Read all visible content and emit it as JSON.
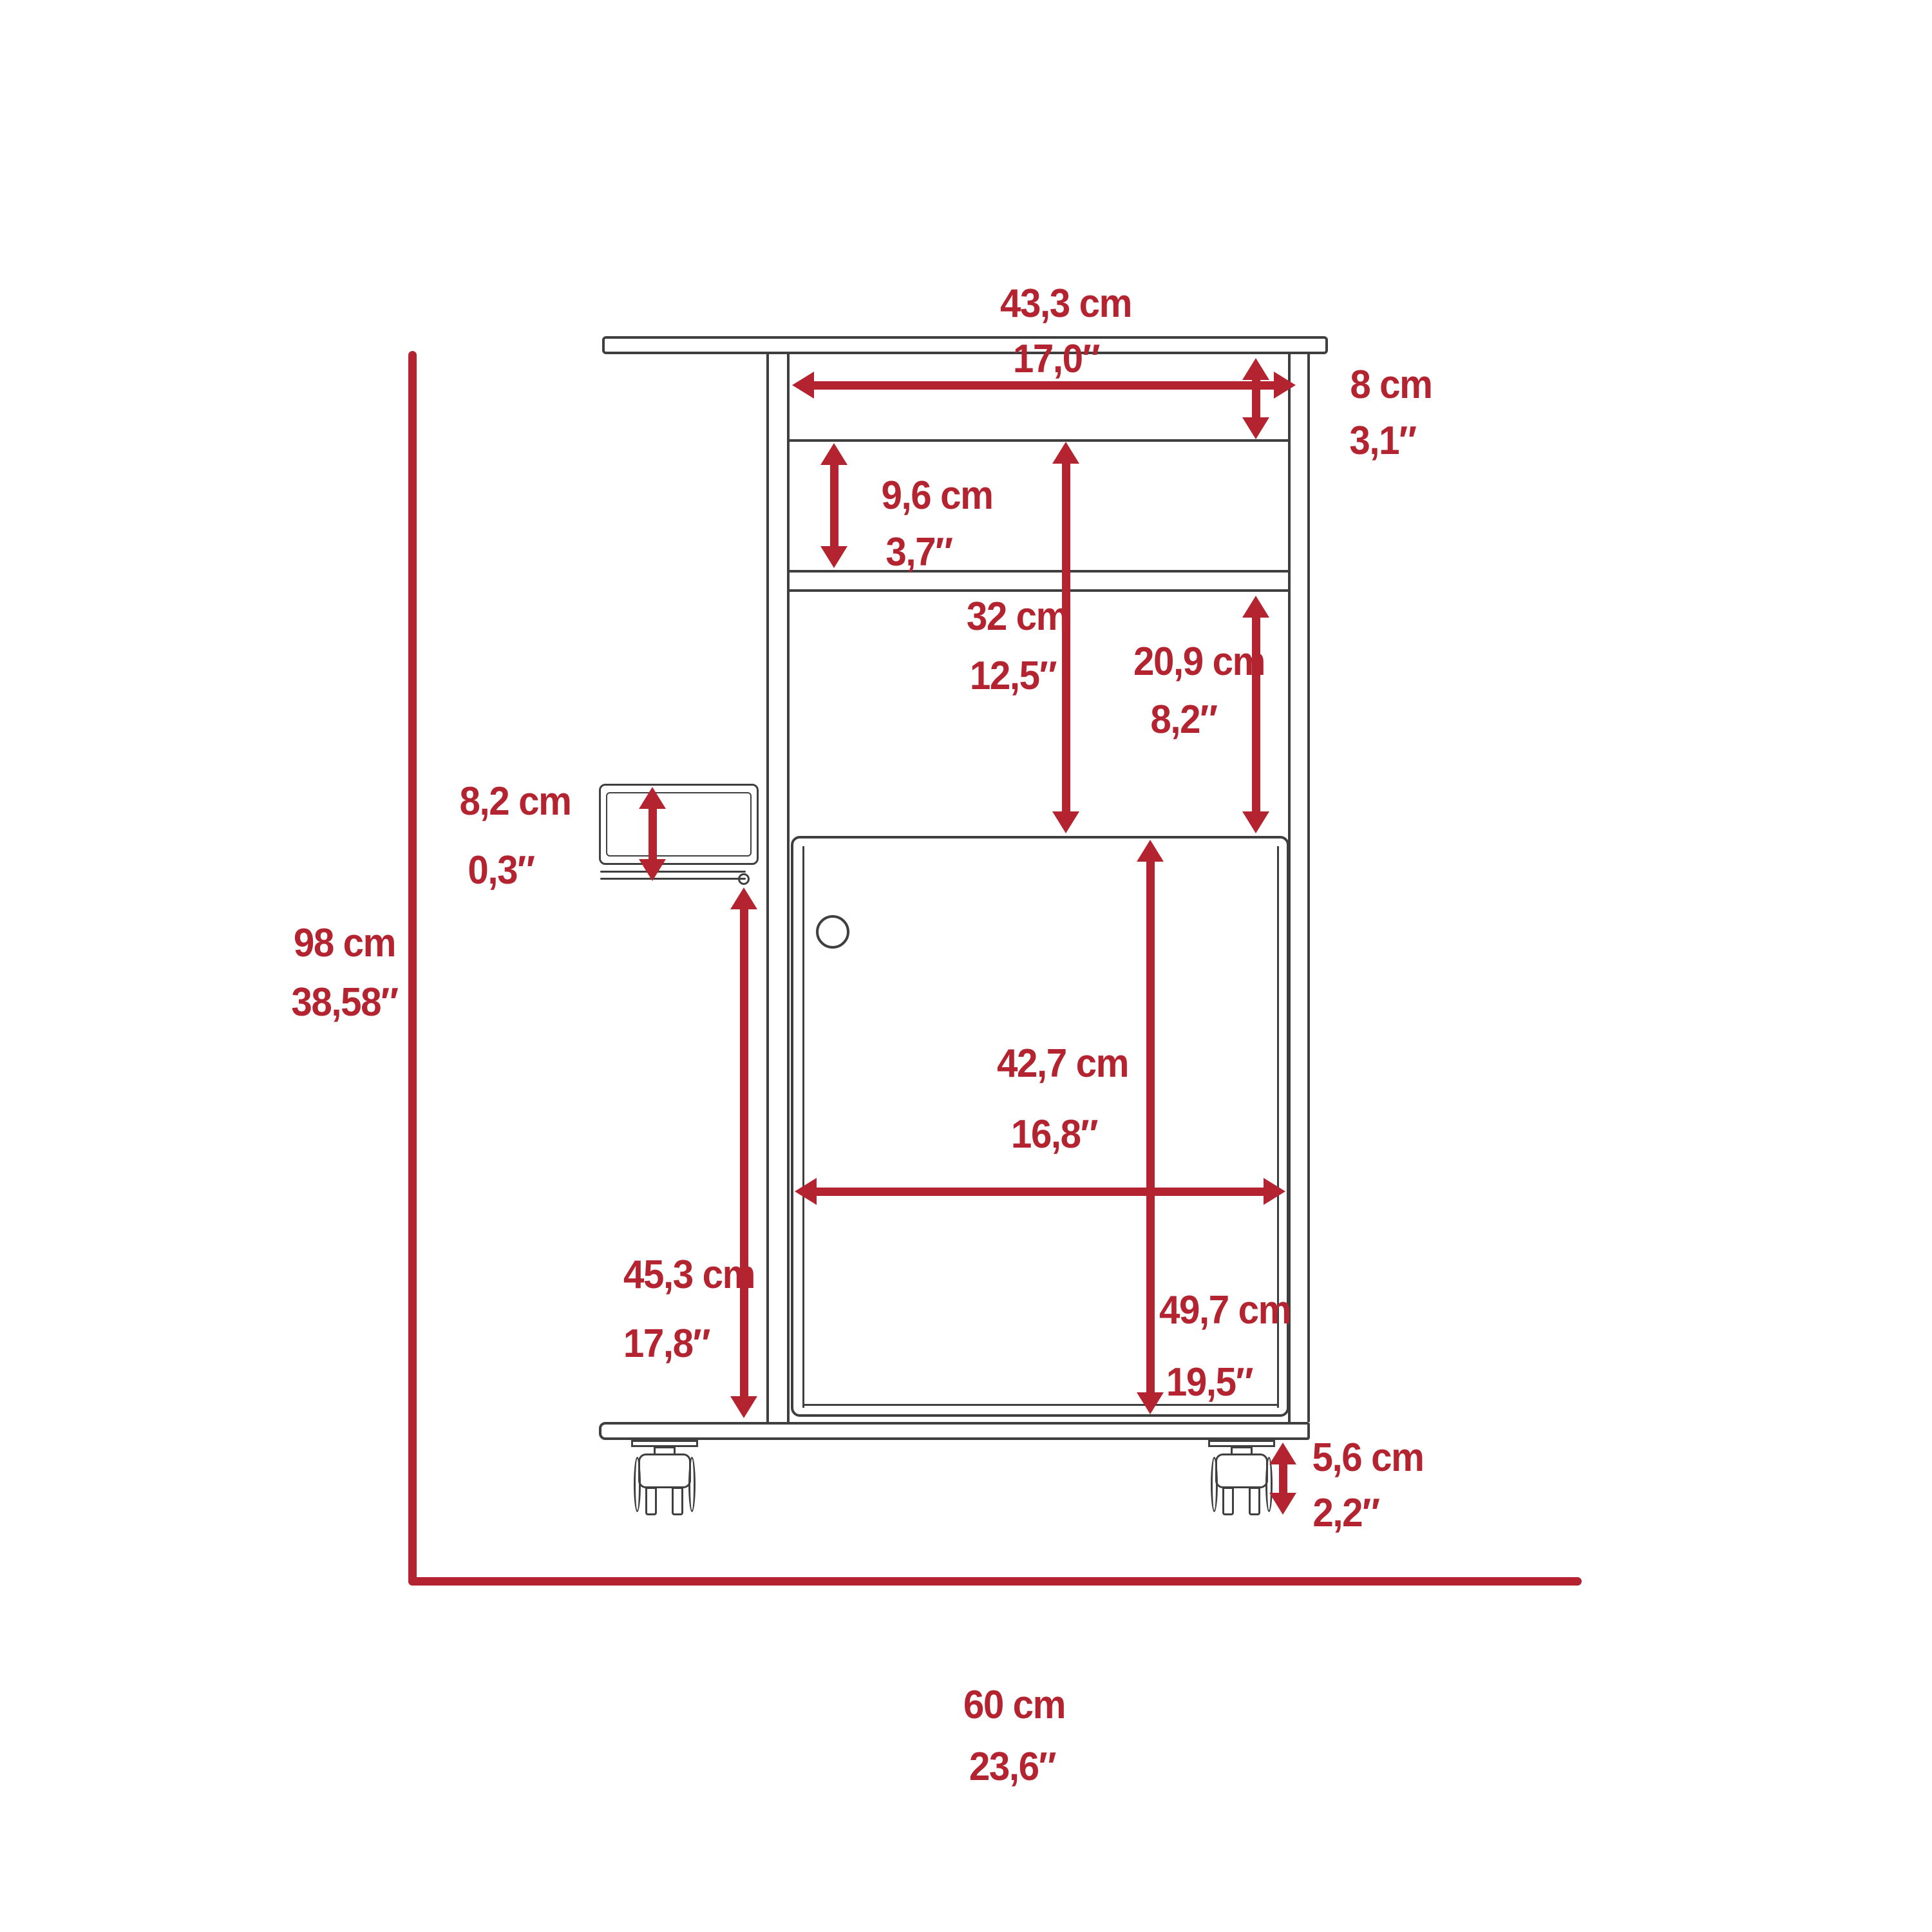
{
  "theme": {
    "accent_red": "#b42430",
    "line_ink": "#3f3f3f",
    "background": "#ffffff"
  },
  "diagram": {
    "kind": "furniture-dimension-drawing",
    "subject": "bar cart cabinet with casters, front elevation",
    "units": [
      "cm",
      "inches"
    ]
  },
  "dims": {
    "top_width": {
      "cm": "43,3 cm",
      "in": "17,0″"
    },
    "top_niche": {
      "cm": "8 cm",
      "in": "3,1″"
    },
    "mid_niche": {
      "cm": "9,6 cm",
      "in": "3,7″"
    },
    "open_height": {
      "cm": "32 cm",
      "in": "12,5″"
    },
    "shelf_clear": {
      "cm": "20,9 cm",
      "in": "8,2″"
    },
    "glass_rack": {
      "cm": "8,2 cm",
      "in": "0,3″"
    },
    "overall_height": {
      "cm": "98 cm",
      "in": "38,58″"
    },
    "door_width": {
      "cm": "42,7 cm",
      "in": "16,8″"
    },
    "left_lower": {
      "cm": "45,3 cm",
      "in": "17,8″"
    },
    "door_height": {
      "cm": "49,7 cm",
      "in": "19,5″"
    },
    "caster": {
      "cm": "5,6 cm",
      "in": "2,2″"
    },
    "overall_width": {
      "cm": "60 cm",
      "in": "23,6″"
    }
  }
}
